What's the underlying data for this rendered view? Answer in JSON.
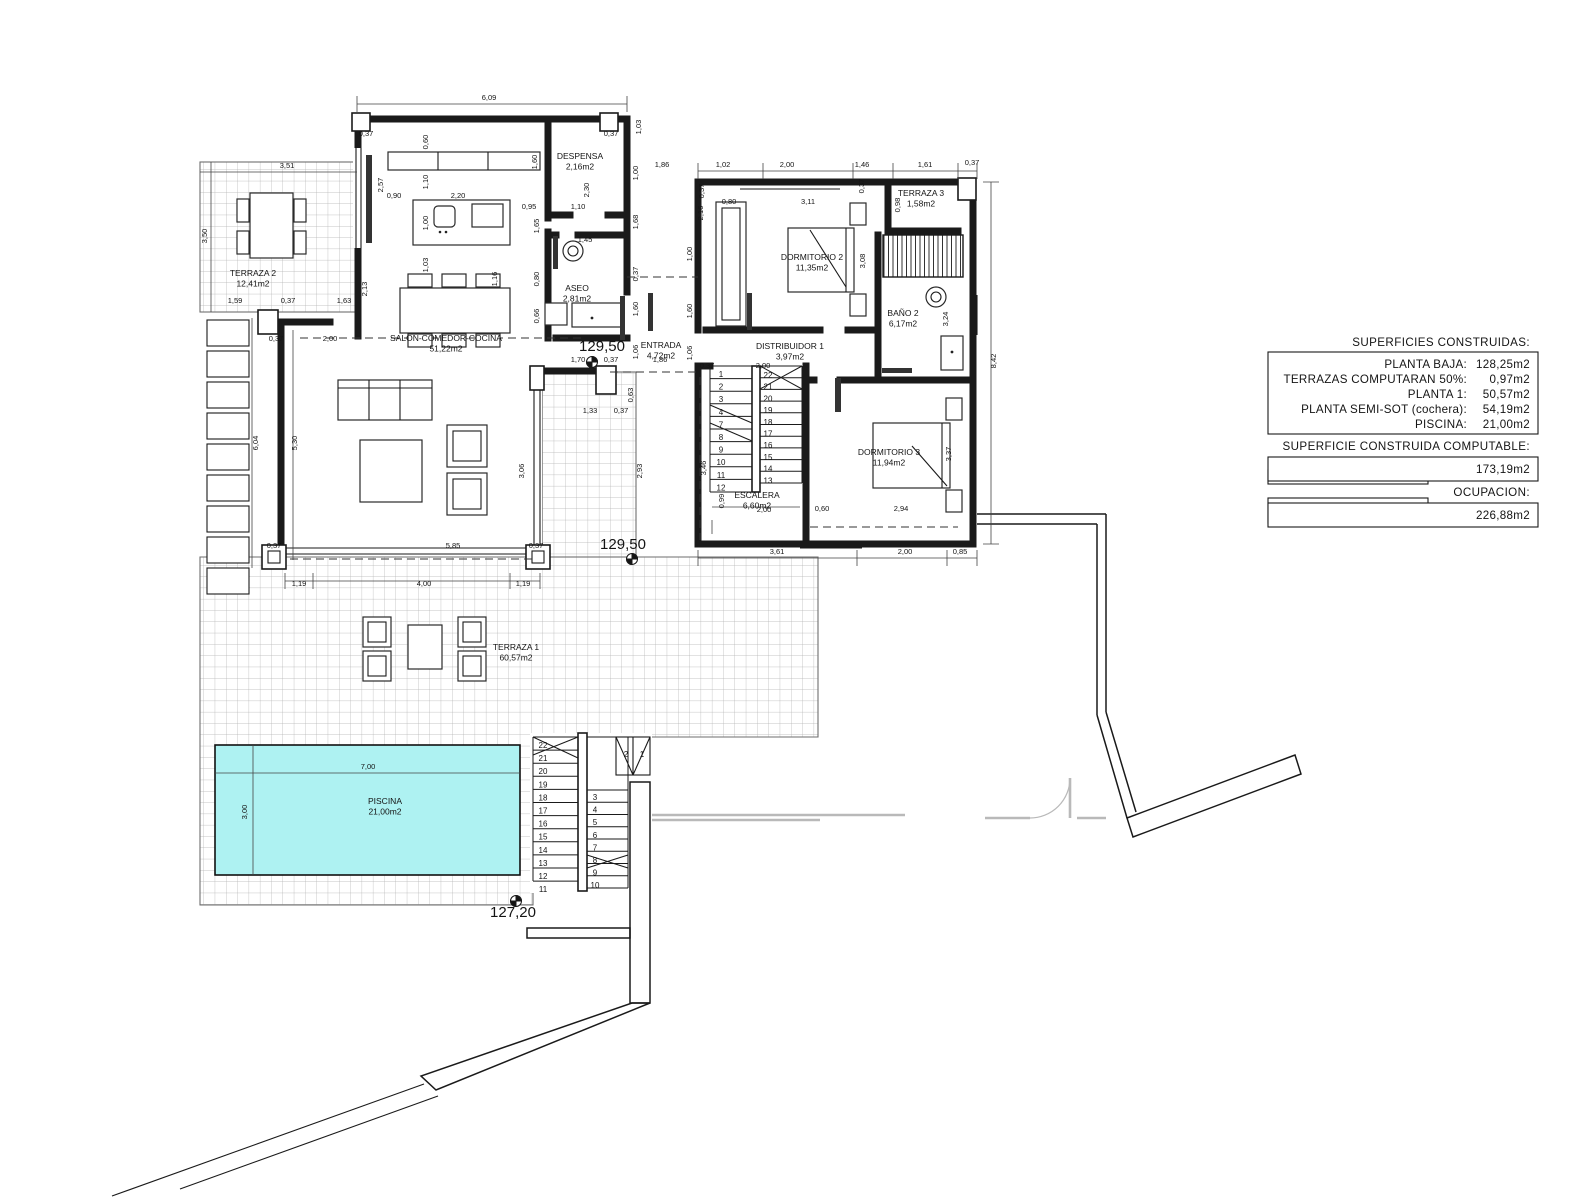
{
  "info_panel": {
    "heading": "SUPERFICIES CONSTRUIDAS:",
    "rows": [
      {
        "label": "PLANTA BAJA:",
        "value": "128,25m2"
      },
      {
        "label": "TERRAZAS COMPUTARAN 50%:",
        "value": "0,97m2"
      },
      {
        "label": "PLANTA 1:",
        "value": "50,57m2"
      },
      {
        "label": "PLANTA SEMI-SOT (cochera):",
        "value": "54,19m2"
      },
      {
        "label": "PISCINA:",
        "value": "21,00m2"
      }
    ],
    "computable_heading": "SUPERFICIE CONSTRUIDA COMPUTABLE:",
    "computable_value": "173,19m2",
    "ocupacion_heading": "OCUPACION:",
    "ocupacion_value": "226,88m2"
  },
  "rooms": [
    {
      "name": "TERRAZA 2",
      "area": "12,41m2",
      "x": 253,
      "y": 276
    },
    {
      "name": "SALON-COMEDOR-COCINA",
      "area": "51,22m2",
      "x": 446,
      "y": 341
    },
    {
      "name": "DESPENSA",
      "area": "2,16m2",
      "x": 580,
      "y": 159
    },
    {
      "name": "ASEO",
      "area": "2,81m2",
      "x": 577,
      "y": 291
    },
    {
      "name": "ENTRADA",
      "area": "4,72m2",
      "x": 661,
      "y": 348
    },
    {
      "name": "DORMITORIO 2",
      "area": "11,35m2",
      "x": 812,
      "y": 260
    },
    {
      "name": "TERRAZA 3",
      "area": "1,58m2",
      "x": 921,
      "y": 196
    },
    {
      "name": "BAÑO 2",
      "area": "6,17m2",
      "x": 903,
      "y": 316
    },
    {
      "name": "DISTRIBUIDOR 1",
      "area": "3,97m2",
      "x": 790,
      "y": 349
    },
    {
      "name": "DORMITORIO 3",
      "area": "11,94m2",
      "x": 889,
      "y": 455
    },
    {
      "name": "ESCALERA",
      "area": "6,60m2",
      "x": 757,
      "y": 498
    },
    {
      "name": "TERRAZA 1",
      "area": "60,57m2",
      "x": 516,
      "y": 650
    },
    {
      "name": "PISCINA",
      "area": "21,00m2",
      "x": 385,
      "y": 804
    }
  ],
  "levels": [
    {
      "t": "129,50",
      "x": 602,
      "y": 351,
      "mx": 592,
      "my": 362
    },
    {
      "t": "129,50",
      "x": 623,
      "y": 549,
      "mx": 632,
      "my": 559
    },
    {
      "t": "127,20",
      "x": 513,
      "y": 917,
      "mx": 516,
      "my": 901
    }
  ],
  "pool": {
    "color": "#aef2f2"
  },
  "dimensions": [
    {
      "t": "6,09",
      "x": 489,
      "y": 100
    },
    {
      "t": "0,37",
      "x": 366,
      "y": 136
    },
    {
      "t": "0,37",
      "x": 611,
      "y": 136
    },
    {
      "t": "1,03",
      "x": 641,
      "y": 127,
      "v": 1
    },
    {
      "t": "0,60",
      "x": 428,
      "y": 142,
      "v": 1
    },
    {
      "t": "2,57",
      "x": 383,
      "y": 185,
      "v": 1
    },
    {
      "t": "1,10",
      "x": 428,
      "y": 182,
      "v": 1
    },
    {
      "t": "1,00",
      "x": 428,
      "y": 223,
      "v": 1
    },
    {
      "t": "1,03",
      "x": 428,
      "y": 265,
      "v": 1
    },
    {
      "t": "0,90",
      "x": 394,
      "y": 198
    },
    {
      "t": "2,20",
      "x": 458,
      "y": 198
    },
    {
      "t": "0,95",
      "x": 529,
      "y": 209
    },
    {
      "t": "1,10",
      "x": 578,
      "y": 209
    },
    {
      "t": "1,60",
      "x": 537,
      "y": 162,
      "v": 1
    },
    {
      "t": "2,30",
      "x": 589,
      "y": 190,
      "v": 1
    },
    {
      "t": "1,00",
      "x": 638,
      "y": 173,
      "v": 1
    },
    {
      "t": "1,68",
      "x": 638,
      "y": 222,
      "v": 1
    },
    {
      "t": "0,37",
      "x": 638,
      "y": 274,
      "v": 1
    },
    {
      "t": "1,60",
      "x": 638,
      "y": 309,
      "v": 1
    },
    {
      "t": "1,06",
      "x": 638,
      "y": 352,
      "v": 1
    },
    {
      "t": "3,51",
      "x": 287,
      "y": 168
    },
    {
      "t": "3,50",
      "x": 207,
      "y": 236,
      "v": 1
    },
    {
      "t": "1,59",
      "x": 235,
      "y": 303
    },
    {
      "t": "0,37",
      "x": 288,
      "y": 303
    },
    {
      "t": "1,63",
      "x": 344,
      "y": 303
    },
    {
      "t": "2,13",
      "x": 367,
      "y": 289,
      "v": 1
    },
    {
      "t": "1,16",
      "x": 497,
      "y": 279,
      "v": 1
    },
    {
      "t": "0,37",
      "x": 276,
      "y": 341
    },
    {
      "t": "2,00",
      "x": 330,
      "y": 341
    },
    {
      "t": "6,04",
      "x": 258,
      "y": 443,
      "v": 1
    },
    {
      "t": "5,30",
      "x": 297,
      "y": 443,
      "v": 1
    },
    {
      "t": "1,65",
      "x": 539,
      "y": 226,
      "v": 1
    },
    {
      "t": "0,80",
      "x": 539,
      "y": 279,
      "v": 1
    },
    {
      "t": "0,66",
      "x": 539,
      "y": 316,
      "v": 1
    },
    {
      "t": "1,45",
      "x": 585,
      "y": 242
    },
    {
      "t": "0,37",
      "x": 274,
      "y": 548
    },
    {
      "t": "5,85",
      "x": 453,
      "y": 548
    },
    {
      "t": "0,37",
      "x": 536,
      "y": 548
    },
    {
      "t": "1,19",
      "x": 299,
      "y": 586
    },
    {
      "t": "4,00",
      "x": 424,
      "y": 586
    },
    {
      "t": "1,19",
      "x": 523,
      "y": 586
    },
    {
      "t": "1,33",
      "x": 590,
      "y": 413
    },
    {
      "t": "0,37",
      "x": 621,
      "y": 413
    },
    {
      "t": "0,63",
      "x": 633,
      "y": 395,
      "v": 1
    },
    {
      "t": "3,06",
      "x": 524,
      "y": 471,
      "v": 1
    },
    {
      "t": "2,93",
      "x": 642,
      "y": 471,
      "v": 1
    },
    {
      "t": "3,46",
      "x": 706,
      "y": 468,
      "v": 1
    },
    {
      "t": "1,70",
      "x": 578,
      "y": 362
    },
    {
      "t": "0,37",
      "x": 611,
      "y": 362
    },
    {
      "t": "1,86",
      "x": 660,
      "y": 362
    },
    {
      "t": "1,86",
      "x": 662,
      "y": 167
    },
    {
      "t": "1,02",
      "x": 723,
      "y": 167
    },
    {
      "t": "2,00",
      "x": 787,
      "y": 167
    },
    {
      "t": "1,46",
      "x": 862,
      "y": 167
    },
    {
      "t": "1,61",
      "x": 925,
      "y": 167
    },
    {
      "t": "0,37",
      "x": 972,
      "y": 165
    },
    {
      "t": "0,80",
      "x": 729,
      "y": 204
    },
    {
      "t": "3,11",
      "x": 808,
      "y": 204
    },
    {
      "t": "2,16",
      "x": 703,
      "y": 213,
      "v": 1
    },
    {
      "t": "0,37",
      "x": 704,
      "y": 191,
      "v": 1
    },
    {
      "t": "0,37",
      "x": 864,
      "y": 186,
      "v": 1
    },
    {
      "t": "0,98",
      "x": 900,
      "y": 205,
      "v": 1
    },
    {
      "t": "3,08",
      "x": 865,
      "y": 261,
      "v": 1
    },
    {
      "t": "3,24",
      "x": 948,
      "y": 319,
      "v": 1
    },
    {
      "t": "8,42",
      "x": 996,
      "y": 361,
      "v": 1
    },
    {
      "t": "1,00",
      "x": 692,
      "y": 254,
      "v": 1
    },
    {
      "t": "1,60",
      "x": 692,
      "y": 311,
      "v": 1
    },
    {
      "t": "1,06",
      "x": 692,
      "y": 353,
      "v": 1
    },
    {
      "t": "0,37",
      "x": 707,
      "y": 368
    },
    {
      "t": "2,00",
      "x": 763,
      "y": 368
    },
    {
      "t": "2,00",
      "x": 764,
      "y": 512
    },
    {
      "t": "0,99",
      "x": 724,
      "y": 501,
      "v": 1
    },
    {
      "t": "0,60",
      "x": 822,
      "y": 511
    },
    {
      "t": "2,94",
      "x": 901,
      "y": 511
    },
    {
      "t": "3,37",
      "x": 951,
      "y": 454,
      "v": 1
    },
    {
      "t": "3,61",
      "x": 777,
      "y": 554
    },
    {
      "t": "2,00",
      "x": 905,
      "y": 554
    },
    {
      "t": "0,85",
      "x": 960,
      "y": 554
    },
    {
      "t": "7,00",
      "x": 368,
      "y": 769
    },
    {
      "t": "3,00",
      "x": 247,
      "y": 812,
      "v": 1
    }
  ],
  "stairs": {
    "upper_left": {
      "x": 721,
      "y0": 377,
      "dy": 12.6,
      "values": [
        "1",
        "2",
        "3",
        "4",
        "7",
        "8",
        "9",
        "10",
        "11",
        "12"
      ]
    },
    "upper_right": {
      "x": 768,
      "y0": 378,
      "dy": 11.7,
      "values": [
        "22",
        "21",
        "20",
        "19",
        "18",
        "17",
        "16",
        "15",
        "14",
        "13"
      ]
    },
    "lower_left": {
      "x": 543,
      "y0": 748,
      "dy": 13.1,
      "values": [
        "22",
        "21",
        "20",
        "19",
        "18",
        "17",
        "16",
        "15",
        "14",
        "13",
        "12",
        "11"
      ]
    },
    "lower_right": {
      "x": 595,
      "y0": 800,
      "dy": 12.6,
      "values": [
        "3",
        "4",
        "5",
        "6",
        "7",
        "8",
        "9",
        "10"
      ]
    },
    "lower_top": [
      {
        "t": "2",
        "x": 626,
        "y": 757
      },
      {
        "t": "1",
        "x": 642,
        "y": 757
      }
    ]
  }
}
